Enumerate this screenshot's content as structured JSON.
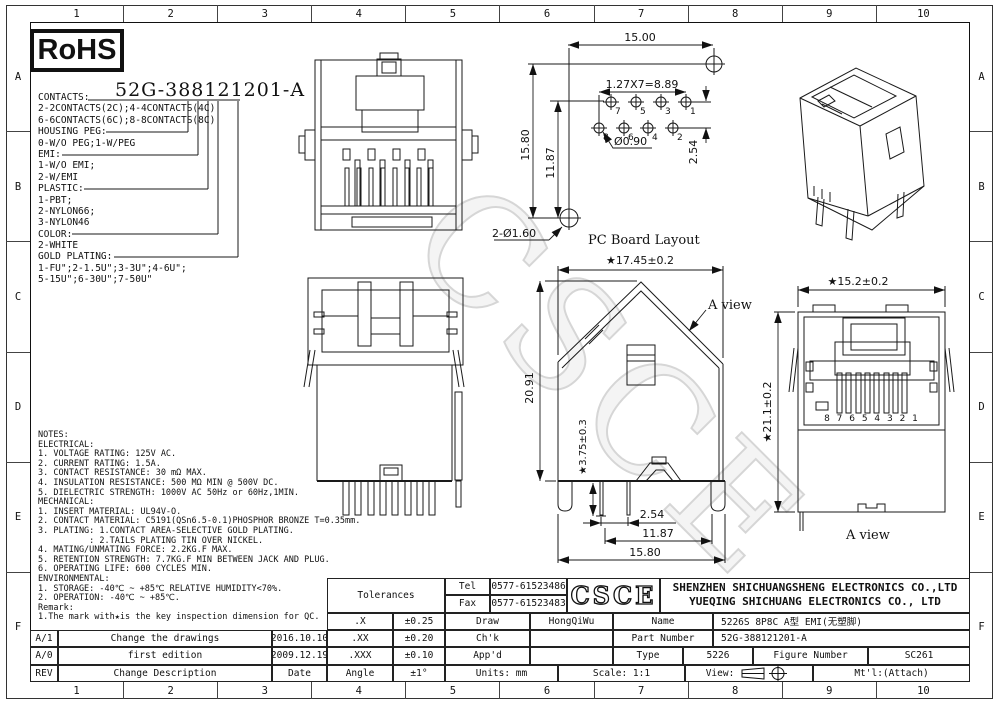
{
  "sheet": {
    "columns": [
      "1",
      "2",
      "3",
      "4",
      "5",
      "6",
      "7",
      "8",
      "9",
      "10"
    ],
    "rows": [
      "A",
      "B",
      "C",
      "D",
      "E",
      "F"
    ],
    "watermark": "CSCE",
    "rohs": "RoHS",
    "heading": "52G-388121201-A"
  },
  "ordering": {
    "lines": [
      "CONTACTS:",
      "2-2CONTACTS(2C);4-4CONTACTS(4C)",
      "6-6CONTACTS(6C);8-8CONTACTS(8C)",
      "HOUSING PEG:",
      "0-W/O PEG;1-W/PEG",
      "EMI:",
      "1-W/O EMI;",
      "2-W/EMI",
      "PLASTIC:",
      "1-PBT;",
      "2-NYLON66;",
      "3-NYLON46",
      "COLOR:",
      "2-WHITE",
      "GOLD PLATING:",
      "1-FU\";2-1.5U\";3-3U\";4-6U\";",
      "5-15U\";6-30U\";7-50U\""
    ]
  },
  "notes": {
    "lines": [
      "NOTES:",
      "ELECTRICAL:",
      "1. VOLTAGE RATING: 125V AC.",
      "2. CURRENT RATING: 1.5A.",
      "3. CONTACT RESISTANCE: 30 mΩ MAX.",
      "4. INSULATION RESISTANCE: 500 MΩ MIN @ 500V DC.",
      "5. DIELECTRIC STRENGTH: 1000V AC 50Hz or 60Hz,1MIN.",
      "MECHANICAL:",
      "1. INSERT MATERIAL: UL94V-O.",
      "2. CONTACT MATERIAL: C5191(QSn6.5-0.1)PHOSPHOR BRONZE T=0.35mm.",
      "3. PLATING: 1.CONTACT AREA-SELECTIVE GOLD PLATING.",
      "          : 2.TAILS PLATING TIN OVER NICKEL.",
      "4. MATING/UNMATING FORCE: 2.2KG.F MAX.",
      "5. RETENTION STRENGTH: 7.7KG.F MIN BETWEEN JACK AND PLUG.",
      "6. OPERATING LIFE: 600 CYCLES MIN.",
      "ENVIRONMENTAL:",
      "1. STORAGE: -40℃ ~ +85℃ RELATIVE HUMIDITY<70%.",
      "2. OPERATION: -40℃ ~ +85℃.",
      "Remark:",
      "1.The mark with★is the key inspection dimension for QC."
    ]
  },
  "pcb": {
    "title": "PC Board Layout",
    "d_width": "15.00",
    "d_pitch": "1.27X7=8.89",
    "d_h1": "15.80",
    "d_h2": "11.87",
    "d_hole": "Ø0.90",
    "d_rowgap": "2.54",
    "d_mount": "2-Ø1.60",
    "top_pins": [
      "7",
      "5",
      "3",
      "1"
    ],
    "bot_pins": [
      "8",
      "6",
      "4",
      "2"
    ]
  },
  "bottom_view": {
    "d_width": "★17.45±0.2",
    "d_height": "20.91",
    "d_pin": "★3.75±0.3",
    "d_pitch": "2.54",
    "d_span": "11.87",
    "d_base": "15.80",
    "label": "A view"
  },
  "front_view": {
    "d_width": "★15.2±0.2",
    "d_height": "★21.1±0.2",
    "pins": "8 7 6 5 4 3 2 1",
    "label": "A view"
  },
  "title_block": {
    "tolerances_label": "Tolerances",
    "tol_rows": [
      {
        "label": ".X",
        "value": "±0.25"
      },
      {
        "label": ".XX",
        "value": "±0.20"
      },
      {
        "label": ".XXX",
        "value": "±0.10"
      },
      {
        "label": "Angle",
        "value": "±1°"
      }
    ],
    "tel_label": "Tel",
    "tel": "0577-61523486",
    "fax_label": "Fax",
    "fax": "0577-61523483",
    "logo": "CSCE",
    "company_line1": "SHENZHEN SHICHUANGSHENG ELECTRONICS CO.,LTD",
    "company_line2": "YUEQING SHICHUANG ELECTRONICS CO., LTD",
    "draw_label": "Draw",
    "draw_value": "HongQiWu",
    "chk_label": "Ch'k",
    "appd_label": "App'd",
    "name_label": "Name",
    "name_value": "5226S 8P8C A型 EMI(无塑脚)",
    "part_number_label": "Part Number",
    "part_number_value": "52G-388121201-A",
    "type_label": "Type",
    "type_value": "5226",
    "figure_label": "Figure Number",
    "figure_value": "SC261",
    "units": "Units: mm",
    "scale": "Scale: 1:1",
    "view_label": "View:",
    "mtl": "Mt'l:(Attach)"
  },
  "revisions": {
    "rows": [
      {
        "rev": "A/1",
        "desc": "Change the drawings",
        "date": "2016.10.10"
      },
      {
        "rev": "A/0",
        "desc": "first edition",
        "date": "2009.12.19"
      },
      {
        "rev": "REV",
        "desc": "Change Description",
        "date": "Date"
      }
    ]
  }
}
